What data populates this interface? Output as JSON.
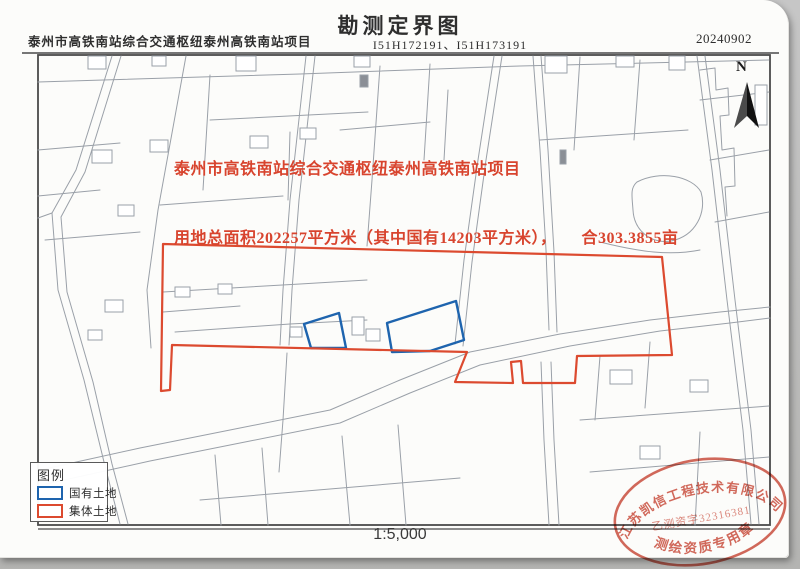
{
  "page": {
    "header": {
      "project_name": "泰州市高铁南站综合交通枢纽泰州高铁南站项目",
      "title": "勘测定界图",
      "sheet_numbers": "I51H172191、I51H173191",
      "date": "20240902"
    },
    "map": {
      "annotation_line1": "泰州市高铁南站综合交通枢纽泰州高铁南站项目",
      "annotation_line2": "用地总面积202257平方米（其中国有14203平方米），　　合303.3855亩",
      "north_label": "N"
    },
    "legend": {
      "title": "图例",
      "items": [
        {
          "label": "国有土地"
        },
        {
          "label": "集体土地"
        }
      ]
    },
    "scale_label": "1:5,000",
    "stamp": {
      "company": "江苏凯信工程技术有限公司",
      "license": "乙测资字32316381",
      "seal_type": "测绘资质专用章"
    }
  },
  "colors": {
    "red_boundary": "#dc4a2f",
    "red_text": "#d8442e",
    "blue_boundary": "#1e64ae",
    "parcel_line": "#9aa0a8",
    "frame": "#4a4a4a",
    "stamp_red": "#cc4f3f"
  }
}
